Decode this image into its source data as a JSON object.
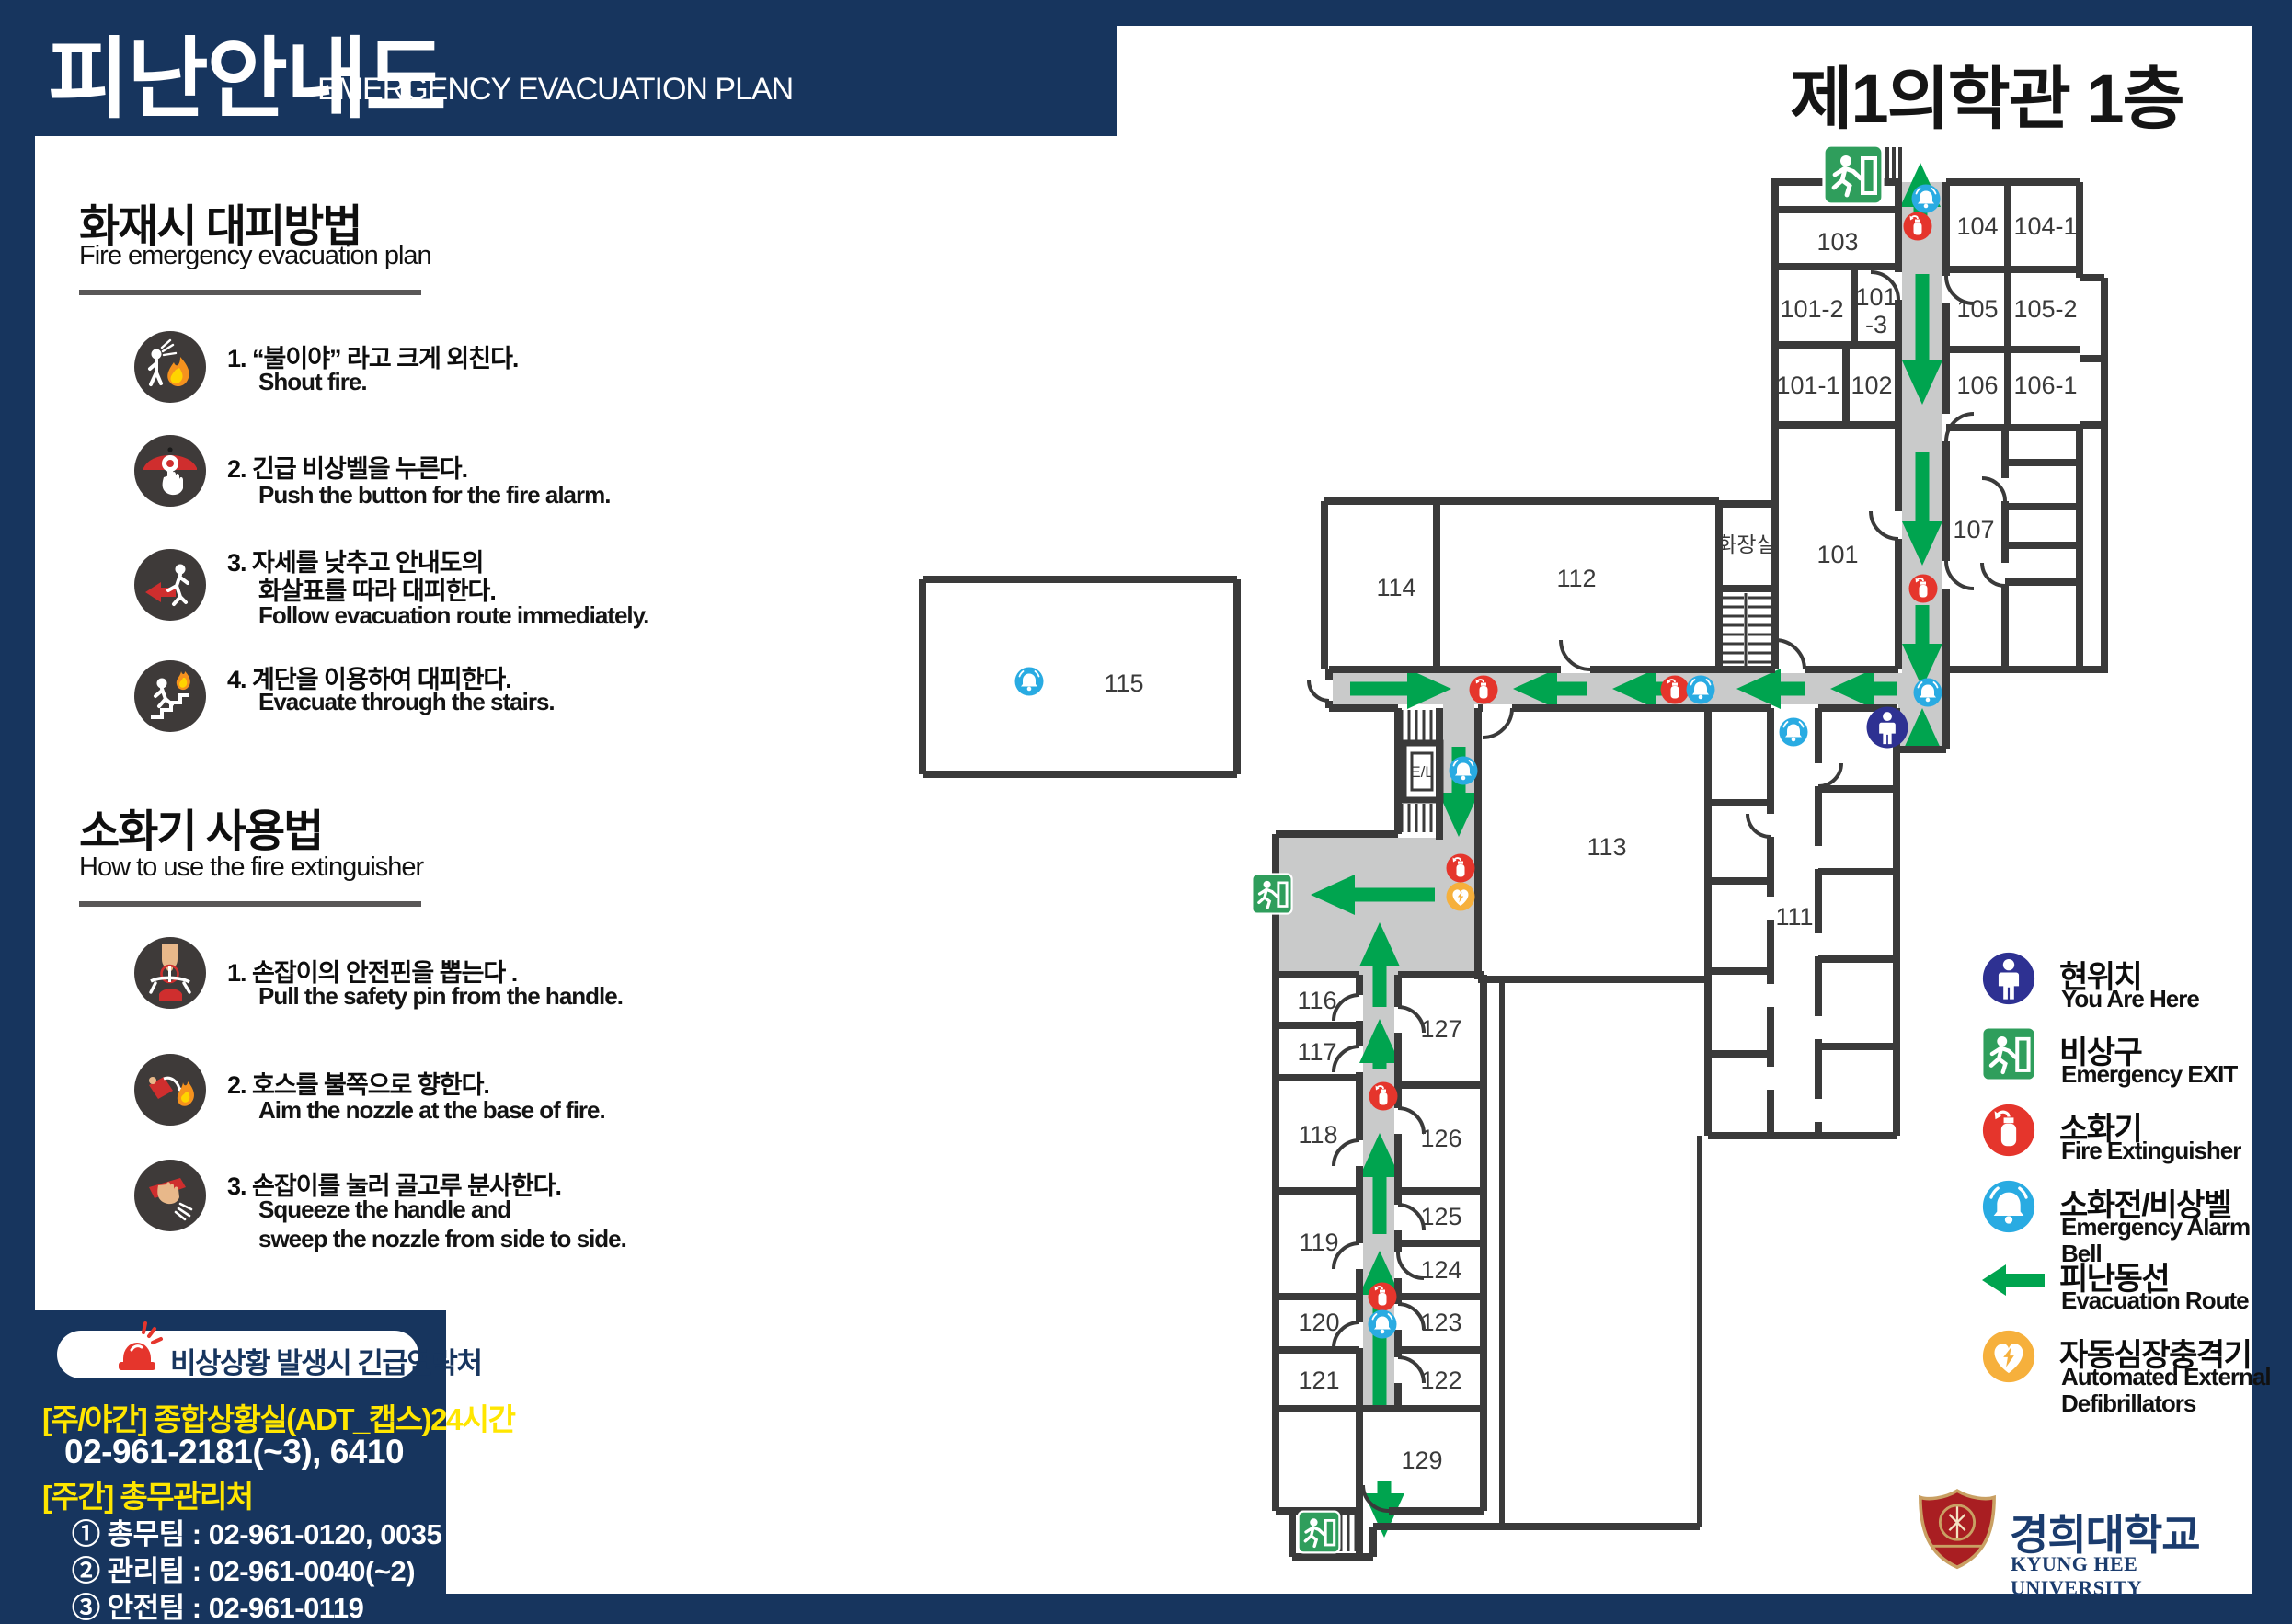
{
  "header": {
    "title_ko": "피난안내도",
    "title_en": "EMERGENCY EVACUATION PLAN"
  },
  "building": {
    "title": "제1의학관 1층"
  },
  "sidebar": {
    "fire": {
      "title": "화재시 대피방법",
      "subtitle": "Fire emergency evacuation plan",
      "steps": [
        {
          "ko": [
            "1. “불이야” 라고 크게 외친다."
          ],
          "en": [
            "Shout fire."
          ]
        },
        {
          "ko": [
            "2. 긴급 비상벨을 누른다."
          ],
          "en": [
            "Push the button for the fire alarm."
          ]
        },
        {
          "ko": [
            "3. 자세를 낮추고 안내도의",
            "화살표를 따라 대피한다."
          ],
          "en": [
            "Follow evacuation route immediately."
          ]
        },
        {
          "ko": [
            "4. 계단을 이용하여 대피한다."
          ],
          "en": [
            "Evacuate through the stairs."
          ]
        }
      ]
    },
    "extinguisher": {
      "title": "소화기 사용법",
      "subtitle": "How to use the fire extinguisher",
      "steps": [
        {
          "ko": [
            "1. 손잡이의 안전핀을 뽑는다 ."
          ],
          "en": [
            "Pull the safety pin from the handle."
          ]
        },
        {
          "ko": [
            "2. 호스를 불쪽으로 향한다."
          ],
          "en": [
            "Aim the nozzle at the base of fire."
          ]
        },
        {
          "ko": [
            "3. 손잡이를 눌러 골고루 분사한다."
          ],
          "en": [
            "Squeeze the handle and",
            "sweep the nozzle from side to side."
          ]
        }
      ]
    }
  },
  "contact": {
    "pill": "비상상황 발생시 긴급연락처",
    "line1_label": "[주/야간] 종합상황실(ADT_캡스)24시간",
    "line1_phone": "02-961-2181(~3), 6410",
    "line2_label": "[주간] 총무관리처",
    "teams": [
      "① 총무팀 : 02-961-0120, 0035",
      "② 관리팀 : 02-961-0040(~2)",
      "③ 안전팀 : 02-961-0119"
    ]
  },
  "legend": {
    "items": [
      {
        "ko": "현위치",
        "en": "You Are Here",
        "icon": "you-are-here-icon"
      },
      {
        "ko": "비상구",
        "en": "Emergency EXIT",
        "icon": "emergency-exit-icon"
      },
      {
        "ko": "소화기",
        "en": "Fire Extinguisher",
        "icon": "fire-extinguisher-icon"
      },
      {
        "ko": "소화전/비상벨",
        "en": "Emergency Alarm Bell",
        "icon": "alarm-bell-icon"
      },
      {
        "ko": "피난동선",
        "en": "Evacuation Route",
        "icon": "evacuation-route-arrow"
      },
      {
        "ko": "자동심장충격기",
        "en": "Automated External Defibrillators",
        "icon": "aed-icon"
      }
    ]
  },
  "logo": {
    "ko": "경희대학교",
    "en": "KYUNG HEE UNIVERSITY"
  },
  "plan": {
    "floor_label": "1F",
    "rooms": [
      "103",
      "104",
      "104-1",
      "101-2",
      "101",
      "-3",
      "105",
      "105-2",
      "101-1",
      "102",
      "106",
      "106-1",
      "101",
      "107",
      "화장실",
      "114",
      "112",
      "115",
      "113",
      "111",
      "E/L",
      "116",
      "117",
      "118",
      "119",
      "120",
      "121",
      "127",
      "126",
      "125",
      "124",
      "123",
      "122",
      "129"
    ],
    "colors": {
      "navy": "#17355e",
      "arrow_green": "#00a44f",
      "exit_green": "#2f9e5c",
      "alarm_blue": "#29abe2",
      "ext_red": "#e5352c",
      "aed_orange": "#f6b03c",
      "yah_navy": "#2e3192",
      "wall": "#3a3a3a",
      "corridor": "#c9caca",
      "contact_yellow": "#ffe600"
    }
  }
}
